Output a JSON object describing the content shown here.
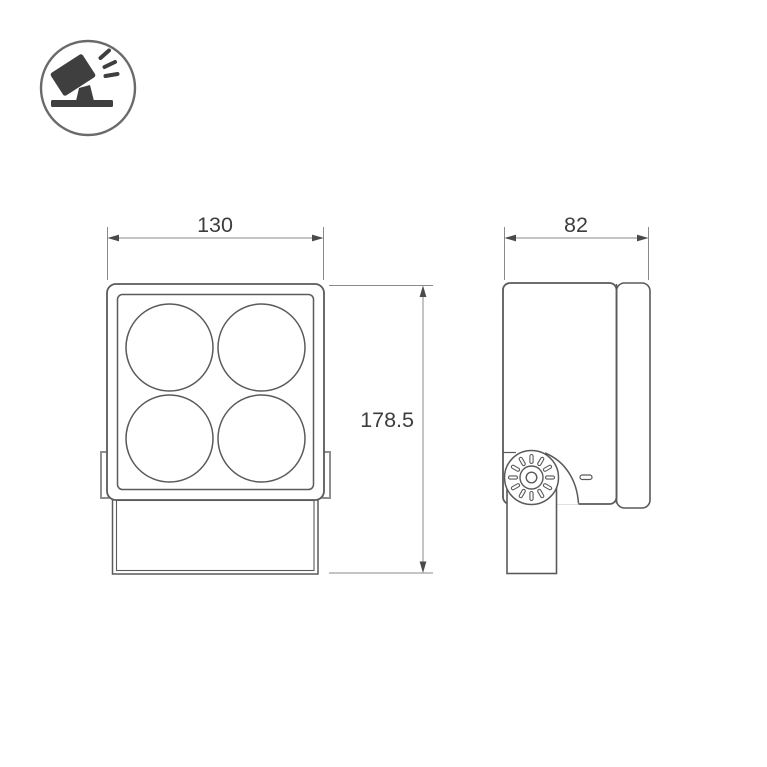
{
  "icon": {
    "name": "tilted-floodlight-icon"
  },
  "dimensions": {
    "front_width": "130",
    "side_depth": "82",
    "overall_height": "178.5"
  },
  "front_view": {
    "lens_count": "4"
  },
  "colors": {
    "background": "#ffffff",
    "outline": "#5a5a5a",
    "light_outline": "#8f8f8f",
    "dimension_line": "#8a8a8a",
    "arrow": "#4a4a4a",
    "label_text": "#3d3d3d",
    "icon_circle": "#6a6a6a",
    "icon_glyph": "#3f3f3f"
  }
}
